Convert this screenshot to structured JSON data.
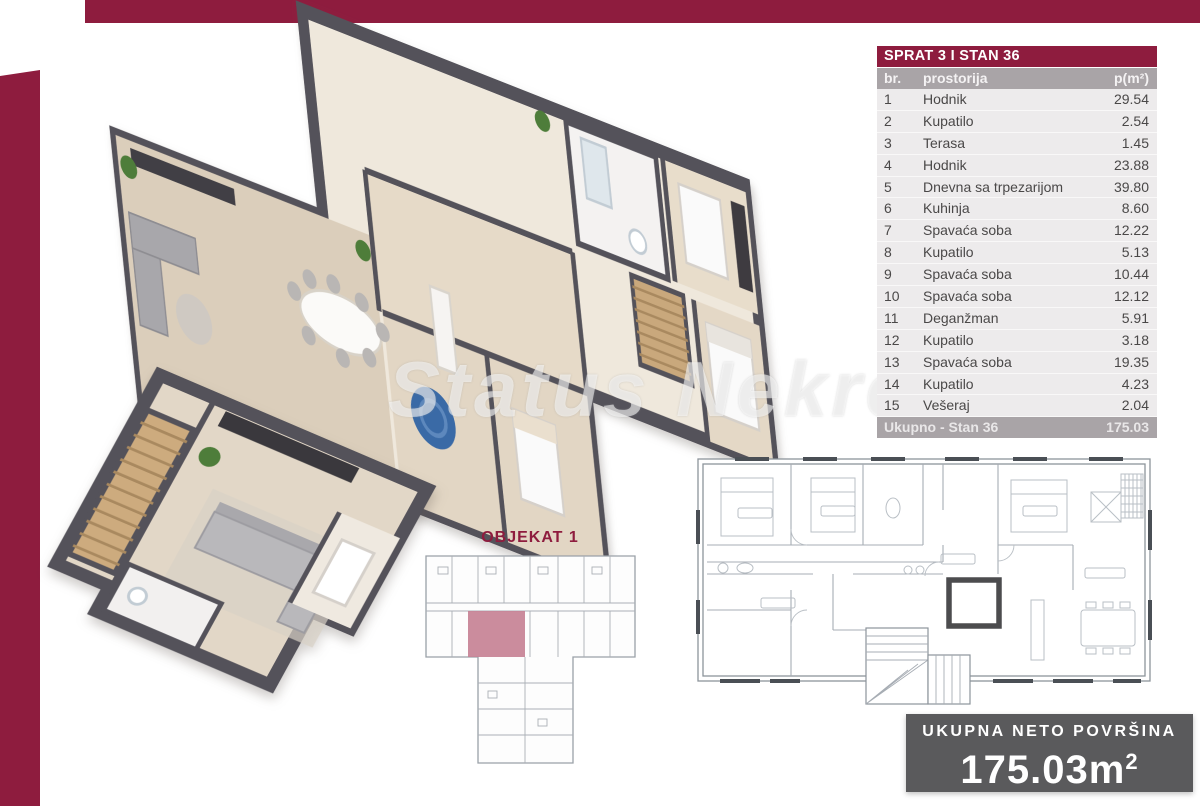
{
  "watermark": "Status Nekret",
  "colors": {
    "maroon": "#8e1c3e",
    "table_gray": "#a9a4a7",
    "row_bg": "#edebec",
    "badge_gray": "#5a5a5c",
    "wall_dark": "#54525a",
    "floor_beige": "#ddd0be",
    "highlight_unit_pink": "#c57f92"
  },
  "table": {
    "title": "SPRAT 3 I STAN 36",
    "columns": {
      "num": "br.",
      "room": "prostorija",
      "area": "p(m²)"
    },
    "rows": [
      {
        "num": "1",
        "room": "Hodnik",
        "area": "29.54"
      },
      {
        "num": "2",
        "room": "Kupatilo",
        "area": "2.54"
      },
      {
        "num": "3",
        "room": "Terasa",
        "area": "1.45"
      },
      {
        "num": "4",
        "room": "Hodnik",
        "area": "23.88"
      },
      {
        "num": "5",
        "room": "Dnevna sa trpezarijom",
        "area": "39.80"
      },
      {
        "num": "6",
        "room": "Kuhinja",
        "area": "8.60"
      },
      {
        "num": "7",
        "room": "Spavaća soba",
        "area": "12.22"
      },
      {
        "num": "8",
        "room": "Kupatilo",
        "area": "5.13"
      },
      {
        "num": "9",
        "room": "Spavaća soba",
        "area": "10.44"
      },
      {
        "num": "10",
        "room": "Spavaća soba",
        "area": "12.12"
      },
      {
        "num": "11",
        "room": "Deganžman",
        "area": "5.91"
      },
      {
        "num": "12",
        "room": "Kupatilo",
        "area": "3.18"
      },
      {
        "num": "13",
        "room": "Spavaća soba",
        "area": "19.35"
      },
      {
        "num": "14",
        "room": "Kupatilo",
        "area": "4.23"
      },
      {
        "num": "15",
        "room": "Vešeraj",
        "area": "2.04"
      }
    ],
    "footer": {
      "label": "Ukupno - Stan 36",
      "total": "175.03"
    }
  },
  "objekat": {
    "label": "OBJEKAT 1"
  },
  "badge": {
    "title": "UKUPNA NETO POVRŠINA",
    "value": "175.03",
    "unit": "m",
    "sup": "2"
  }
}
